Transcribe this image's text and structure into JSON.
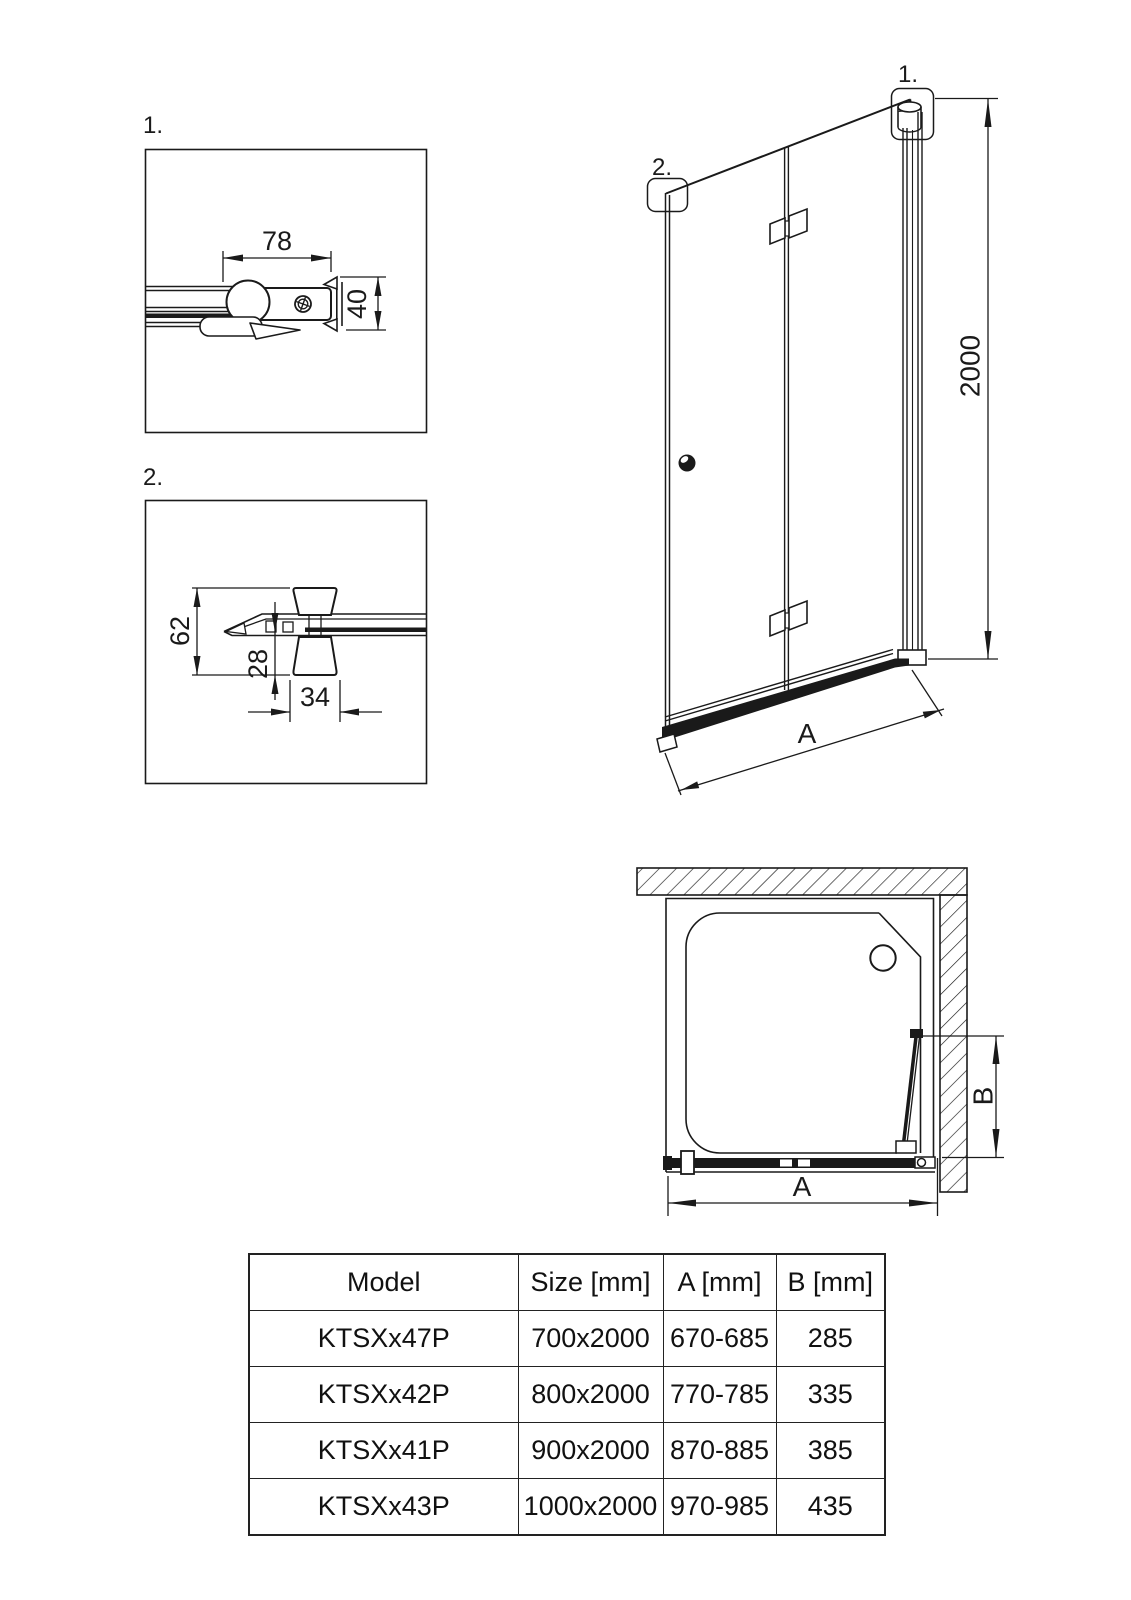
{
  "detail1": {
    "callout": "1.",
    "dim_width": "78",
    "dim_height": "40"
  },
  "detail2": {
    "callout": "2.",
    "dim_height_total": "62",
    "dim_height_lower": "28",
    "dim_width_knob": "34"
  },
  "elevation": {
    "callout_hinge": "1.",
    "callout_bracket": "2.",
    "dim_height": "2000",
    "dim_width": "A"
  },
  "plan": {
    "dim_width": "A",
    "dim_depth": "B"
  },
  "spec_table": {
    "headers": [
      "Model",
      "Size [mm]",
      "A [mm]",
      "B [mm]"
    ],
    "rows": [
      [
        "KTSXx47P",
        "700x2000",
        "670-685",
        "285"
      ],
      [
        "KTSXx42P",
        "800x2000",
        "770-785",
        "335"
      ],
      [
        "KTSXx41P",
        "900x2000",
        "870-885",
        "385"
      ],
      [
        "KTSXx43P",
        "1000x2000",
        "970-985",
        "435"
      ]
    ]
  },
  "colors": {
    "line": "#1a1a1a",
    "background": "#ffffff"
  }
}
